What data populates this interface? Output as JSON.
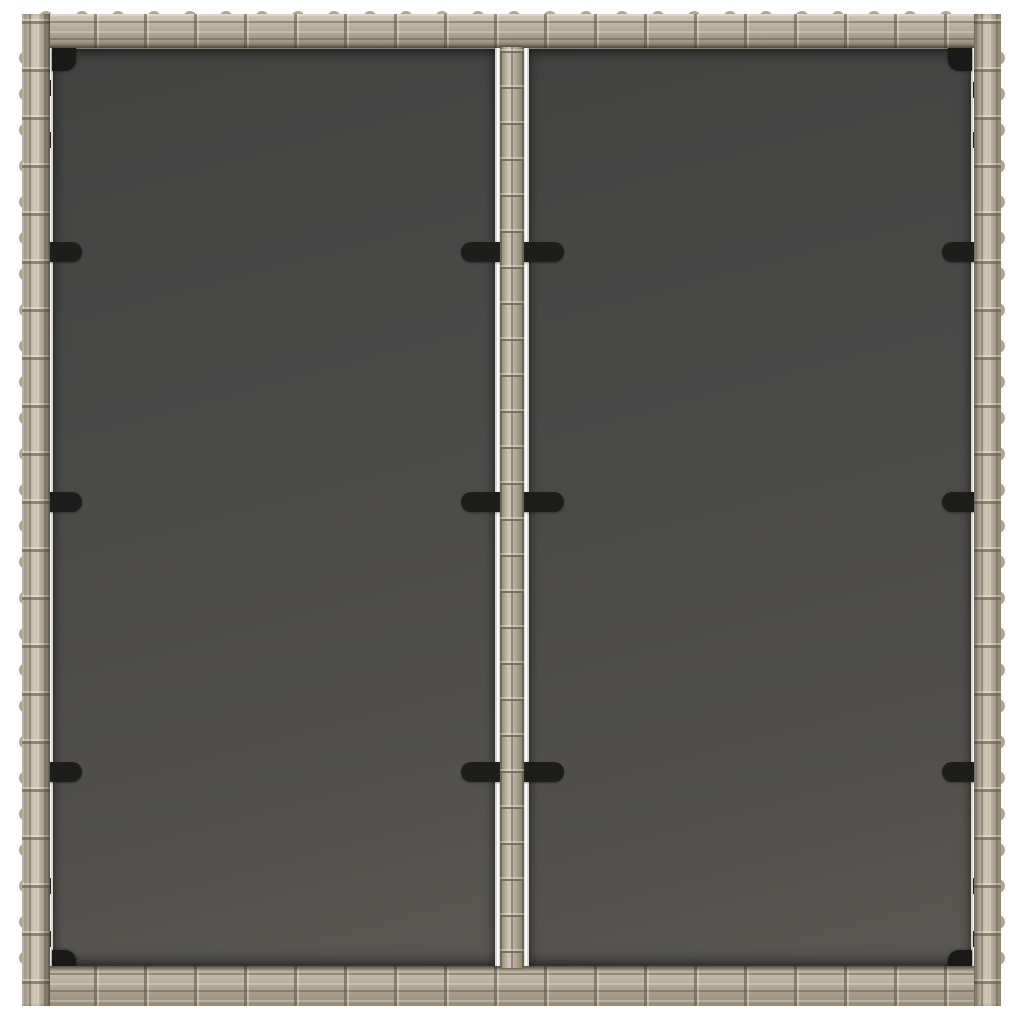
{
  "image": {
    "kind": "product-photo",
    "description": "Top-down view of a square grey poly-rattan garden table: woven rattan outer frame, two dark tinted glass top panels separated by a woven center divider strip, held by black fastening clips, corner brackets and small edge tabs, on a plain white background",
    "background": "#ffffff"
  },
  "palette": {
    "bg": "#ffffff",
    "rattan_base": "#b1a794",
    "rattan_light": "#d2c9b6",
    "rattan_dark": "#6d6355",
    "glass_dark": "#494948",
    "glass_light": "#5a5853",
    "glass_edge_white": "#f1efe7",
    "hardware_black": "#1d1d1c"
  },
  "parts": {
    "frame_sides": 4,
    "glass_panels": 2,
    "center_divider": 1,
    "corner_brackets": 4,
    "edge_clips": 6,
    "divider_clips": 6,
    "edge_tabs": 20
  }
}
